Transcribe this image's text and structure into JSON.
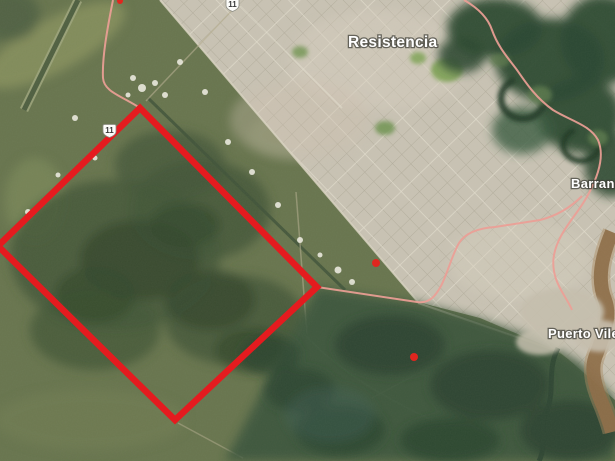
{
  "map_view": {
    "kind": "satellite-imagery",
    "place_labels": [
      {
        "name": "Resistencia",
        "x": 348,
        "y": 47,
        "size": "city"
      },
      {
        "name": "Barranqu",
        "x": 571,
        "y": 188,
        "size": "town",
        "note": "clipped-at-right-edge"
      },
      {
        "name": "Puerto Vilel",
        "x": 548,
        "y": 338,
        "size": "town",
        "note": "clipped-at-right-edge"
      }
    ],
    "route_shields": [
      {
        "number": "11",
        "transform": "translate(226,-2)"
      },
      {
        "number": "11",
        "transform": "translate(103,124)"
      }
    ],
    "boundary_overlay": {
      "shape": "rotated-rectangle",
      "points": "140,108 317,287 175,420 -2,246",
      "color": "#e41b1f",
      "stroke_width": 6.5
    },
    "poi_markers": [
      {
        "x": 376,
        "y": 263,
        "r": 4,
        "color": "#e0261f"
      },
      {
        "x": 414,
        "y": 357,
        "r": 4,
        "color": "#e0261f"
      },
      {
        "x": 120,
        "y": 1,
        "r": 3,
        "color": "#e0261f"
      }
    ],
    "colors": {
      "field_green": "#68754e",
      "forest_green": "#2c4830",
      "urban_gray": "#c9c3b4",
      "river_brown": "#8d6c48",
      "route_pink": "#ee9e95",
      "overlay_red": "#e41b1f",
      "label_white": "#ffffff"
    }
  }
}
